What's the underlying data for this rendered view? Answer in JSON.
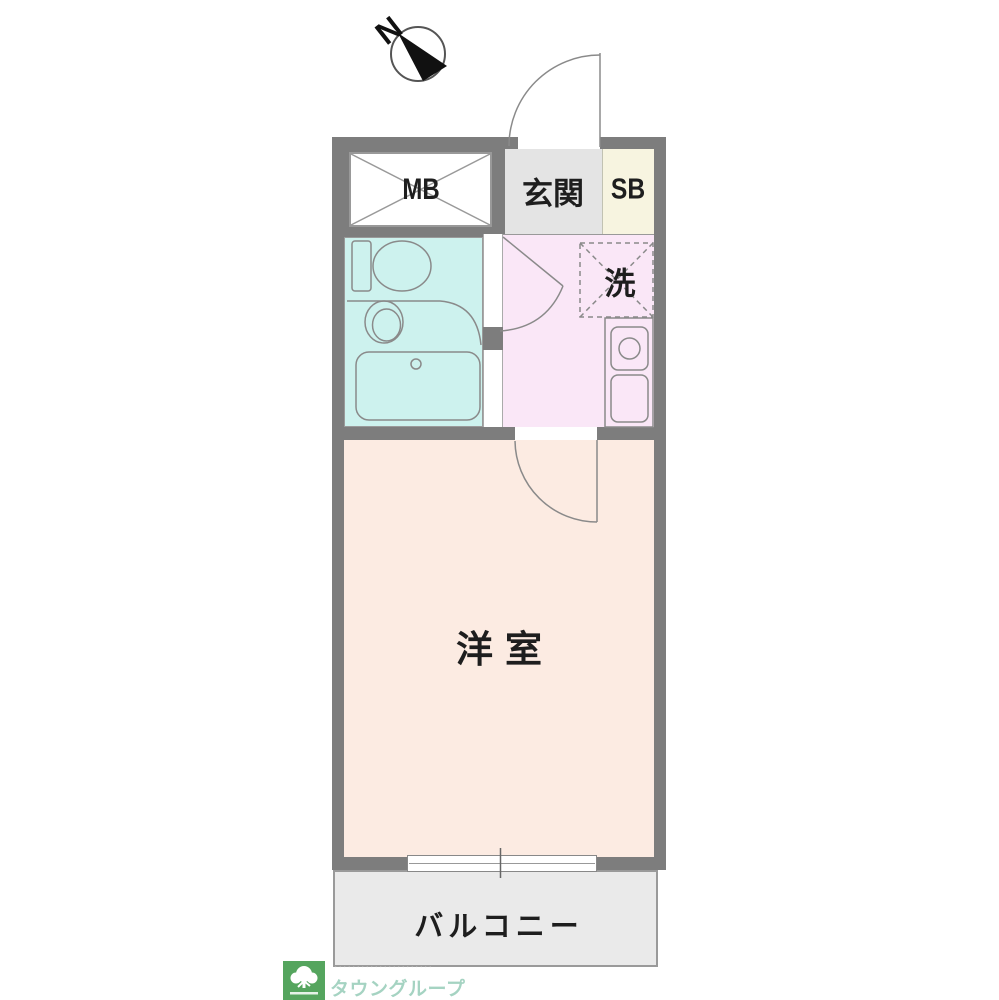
{
  "compass": {
    "north_label": "N"
  },
  "rooms": {
    "meter_box_label": "MB",
    "entrance_label": "玄関",
    "shoe_box_label": "SB",
    "laundry_label": "洗",
    "western_room_label": "洋室",
    "balcony_label": "バルコニー"
  },
  "logo": {
    "brand": "タウングループ",
    "tagline": "･･････････････････････"
  },
  "colors": {
    "wall": "#7d7d7d",
    "bathroom": "#cdf2ee",
    "kitchen_hall": "#fae7f7",
    "western_room": "#fcebe2",
    "entrance": "#e4e4e4",
    "shoe_box": "#f7f4e0",
    "balcony": "#eaeaea",
    "logo_green": "#55a55e",
    "logo_text": "#a5d3c2"
  }
}
